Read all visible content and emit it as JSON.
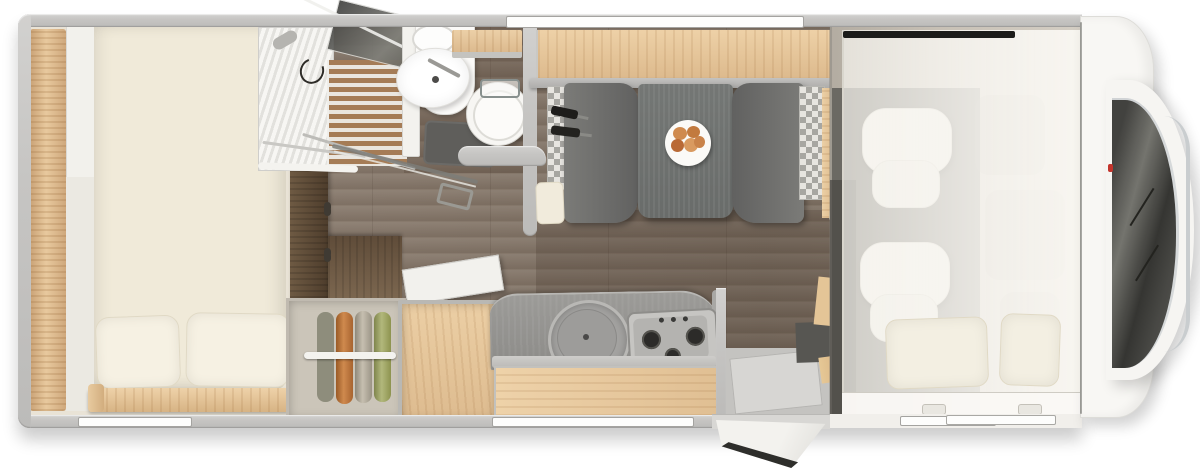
{
  "scene": {
    "description": "Top-down 3D render of a coachbuilt motorhome floor plan",
    "view": "overhead",
    "cab_position": "right side",
    "background_color": "#ffffff",
    "canvas": {
      "width": 1200,
      "height": 472
    }
  },
  "palette": {
    "wall_gray": "#c9c8c6",
    "floor_wood": "#877a6d",
    "light_wood": "#e6c596",
    "walnut_wood": "#5d4a37",
    "mattress_cream": "#f0ead9",
    "bench_dark_gray": "#6d6d6a",
    "table_gray": "#717472",
    "counter_gray": "#989795",
    "cab_body_white": "#f7f6f3",
    "windshield_dark": "#35353",
    "accent_red": "#c3342c"
  },
  "zones": {
    "bedroom": {
      "name": "rear bedroom",
      "features": [
        "rear wall wood trim",
        "side cabinet column",
        "large double bed",
        "two pillows",
        "wood bed rail",
        "walnut partition panel",
        "walnut cabinet top"
      ]
    },
    "shower": {
      "name": "corner shower",
      "features": [
        "ribbed shower tray",
        "teak slat grate floor",
        "leaning glass panel",
        "folding glass door",
        "shower hose",
        "shower head"
      ]
    },
    "bathroom": {
      "name": "washroom",
      "features": [
        "white divider wall",
        "vanity with small top basin",
        "round washbasin with faucet",
        "wood shelf",
        "round toilet",
        "dark bath mat",
        "gray partition wall",
        "toilet surround wall",
        "open glass door across hallway"
      ]
    },
    "dinette": {
      "name": "half-dinette",
      "features": [
        "overhead light-wood sideboard",
        "gray sideboard edge",
        "two facing bench seats",
        "checkered side cushions",
        "black seat belts",
        "gray pedestal table",
        "plate with bread rolls",
        "cream head bolster",
        "cream seat bases"
      ]
    },
    "wardrobe": {
      "name": "open wardrobe",
      "features": [
        "four hanging garments",
        "white clothes rail"
      ],
      "garment_colors": [
        "#8e8d7c",
        "#c07a3e",
        "#b8b1a2",
        "#a3a96f"
      ]
    },
    "fridge": {
      "name": "fridge cabinet",
      "features": [
        "light wood open-top cabinet",
        "white lid swung open",
        "two latch fittings"
      ]
    },
    "kitchen": {
      "name": "kitchen block",
      "features": [
        "curved gray worktop",
        "round sink with cover lid",
        "gas hob with three burners and three knobs",
        "light wood drawer front",
        "worktop end wall"
      ]
    },
    "entry": {
      "name": "entrance",
      "features": [
        "inner step well",
        "dark coat panel",
        "wood side panels",
        "entrance door swung open outside",
        "door sill"
      ]
    },
    "cab": {
      "name": "cab with drop-down bed",
      "features": [
        "translucent stowed overcab bed",
        "black bed header strip",
        "two bed pillows",
        "two white swivel cab seats",
        "dark cab floor",
        "ghosted dashboard",
        "bed front rail with handle",
        "two mounting tabs"
      ]
    },
    "front_end": {
      "name": "vehicle front",
      "features": [
        "white cab body panel",
        "rounded nose",
        "dark windshield",
        "chrome windshield trim",
        "two wipers",
        "small red badge dot"
      ]
    }
  },
  "windows": [
    {
      "name": "top wall window above dinette"
    },
    {
      "name": "bottom wall window beside bed"
    },
    {
      "name": "bottom wall window behind kitchen"
    },
    {
      "name": "cab door window strip"
    }
  ],
  "food_plate": {
    "plate_color": "#fbfaf7",
    "items": 5,
    "item_color": "#c9834a"
  },
  "hob": {
    "burners": 3,
    "knobs": 3
  },
  "seat_belts": 2,
  "hinge_marks": 2
}
